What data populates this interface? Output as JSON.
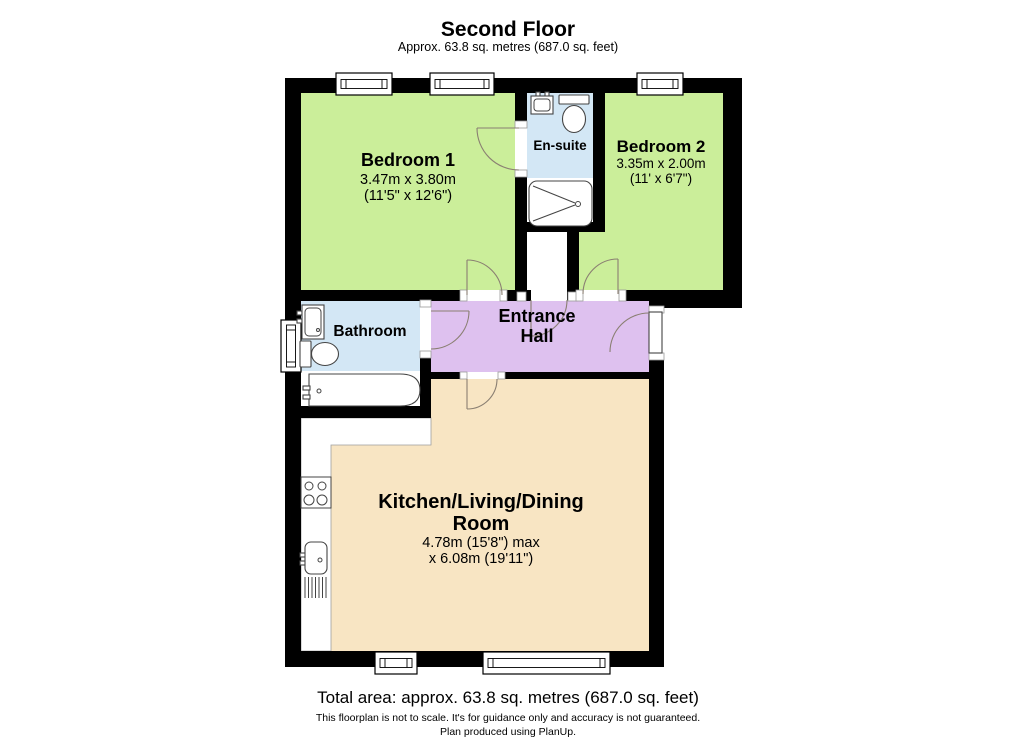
{
  "header": {
    "title": "Second Floor",
    "subtitle": "Approx. 63.8 sq. metres (687.0 sq. feet)"
  },
  "rooms": {
    "bedroom1": {
      "name": "Bedroom 1",
      "dims_metric": "3.47m x 3.80m",
      "dims_imperial": "(11'5\" x 12'6\")"
    },
    "bedroom2": {
      "name": "Bedroom 2",
      "dims_metric": "3.35m x 2.00m",
      "dims_imperial": "(11' x 6'7\")"
    },
    "ensuite": {
      "name": "En-suite"
    },
    "bathroom": {
      "name": "Bathroom"
    },
    "entrance_hall": {
      "line1": "Entrance",
      "line2": "Hall"
    },
    "kitchen": {
      "line1": "Kitchen/Living/Dining",
      "line2": "Room",
      "dims_line1": "4.78m (15'8\") max",
      "dims_line2": "x 6.08m (19'11\")"
    }
  },
  "footer": {
    "total_area": "Total area: approx. 63.8 sq. metres (687.0 sq. feet)",
    "disclaimer": "This floorplan is not to scale. It's for guidance only and accuracy is not guaranteed.",
    "credit": "Plan produced using PlanUp."
  },
  "colors": {
    "bedroom": "#cbee9a",
    "bathroom": "#d3e7f5",
    "hall": "#dec1ef",
    "kitchen": "#f8e5c3",
    "wall": "#000000"
  }
}
